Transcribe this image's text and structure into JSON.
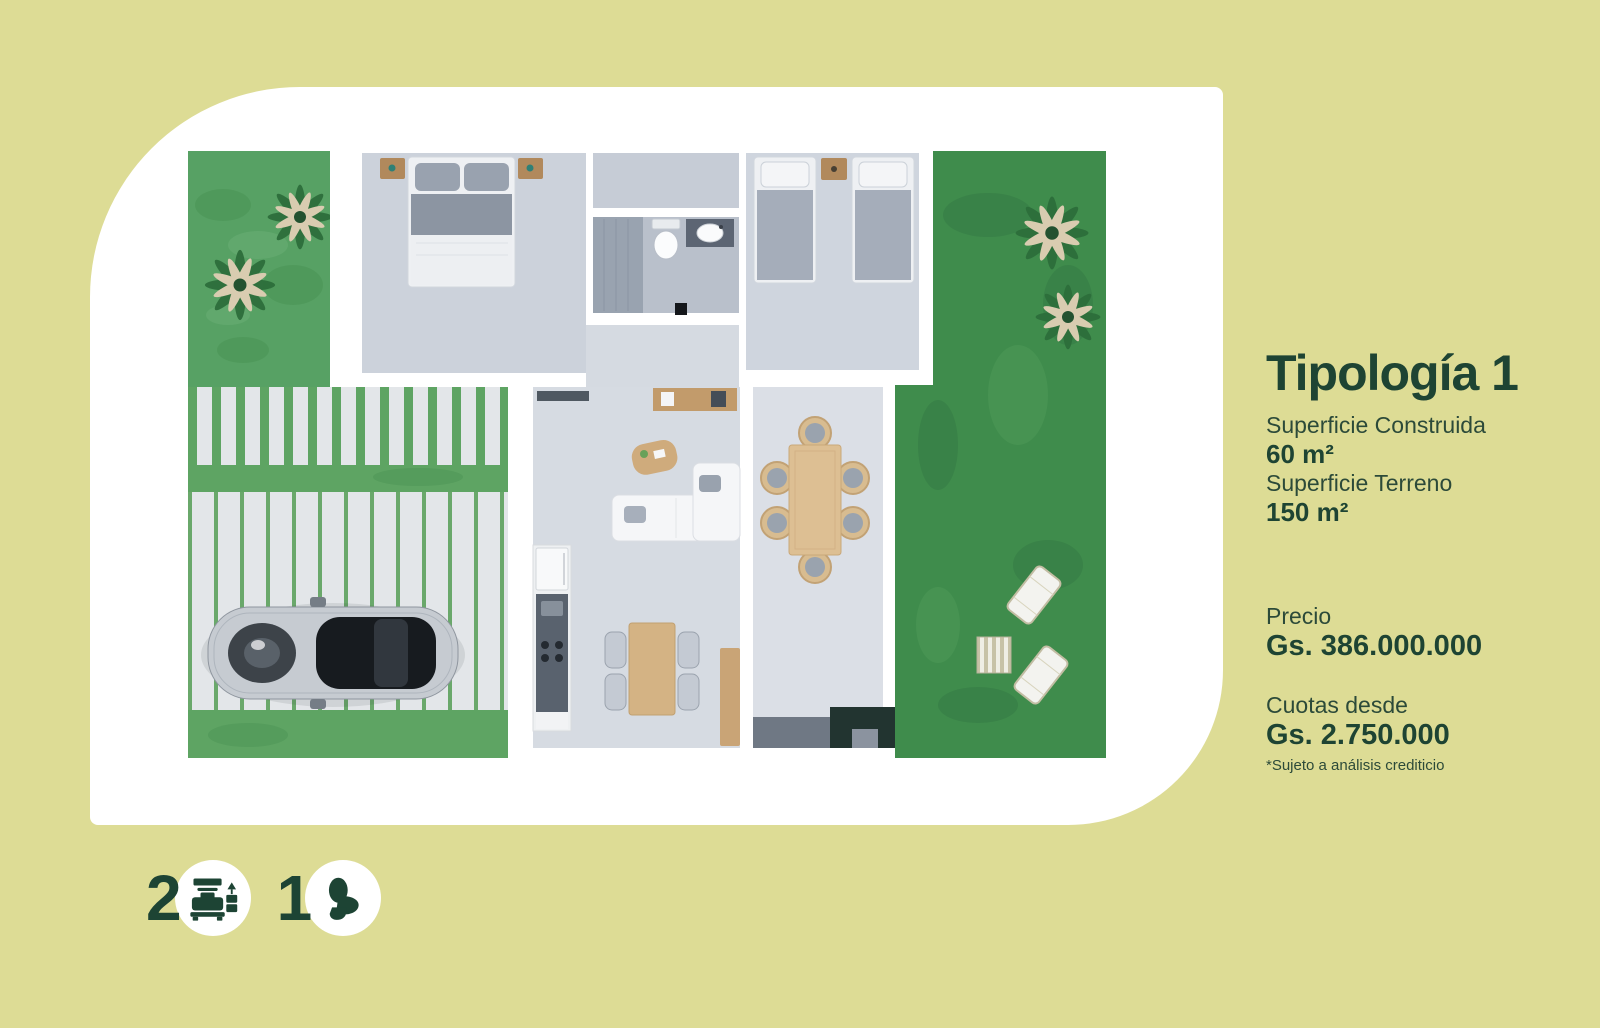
{
  "page": {
    "background_color": "#dddc95",
    "card_color": "#ffffff",
    "accent_dark_green": "#1d4434",
    "label_green": "#2c4a39"
  },
  "plan": {
    "description": "top-view 3d floor plan render",
    "colors": {
      "front_yard_grass": "#57a164",
      "back_garden_grass": "#3f8c4c",
      "driveway_green": "#5ea463",
      "paving_light": "#e3e6e9",
      "floor_gray": "#d6dbe2",
      "wood": "#c9a476",
      "wall_white": "#ffffff"
    }
  },
  "details": {
    "title": "Tipología 1",
    "specs": [
      {
        "label": "Superficie Construida",
        "value": "60 m²"
      },
      {
        "label": "Superficie Terreno",
        "value": "150 m²"
      }
    ],
    "price_label": "Precio",
    "price_value": "Gs. 386.000.000",
    "installments_label": "Cuotas desde",
    "installments_value": "Gs. 2.750.000",
    "disclaimer": "*Sujeto a análisis crediticio"
  },
  "features": {
    "bedrooms": {
      "count": "2",
      "icon": "bed-icon"
    },
    "bathrooms": {
      "count": "1",
      "icon": "toilet-icon"
    }
  }
}
